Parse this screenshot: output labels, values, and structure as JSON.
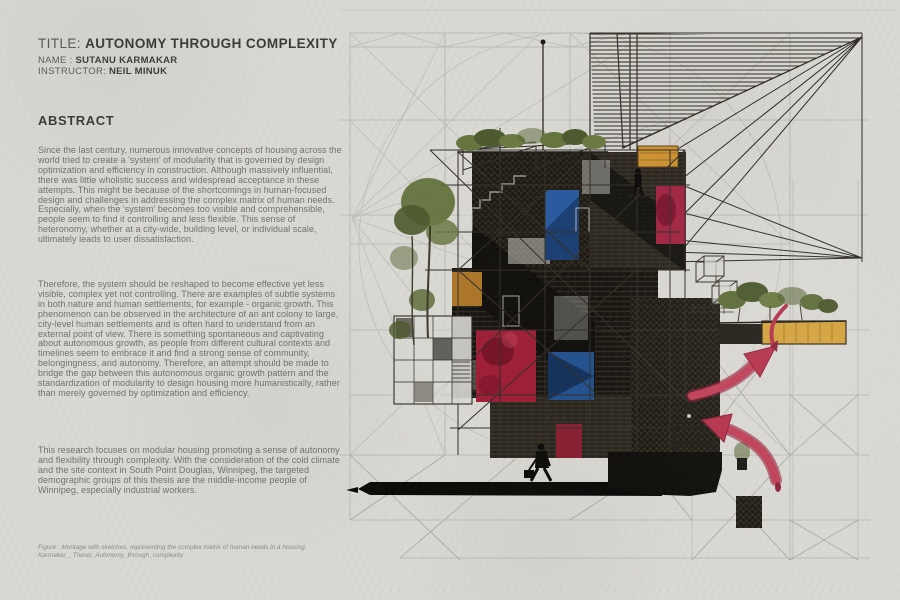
{
  "page": {
    "background_color": "#d9d8d3"
  },
  "header": {
    "title_prefix": "TITLE:",
    "title": "AUTONOMY THROUGH COMPLEXITY",
    "name_label": "NAME :",
    "name": "SUTANU KARMAKAR",
    "instructor_label": "INSTRUCTOR:",
    "instructor": "NEIL MINUK"
  },
  "abstract": {
    "heading": "ABSTRACT",
    "paragraphs": [
      "Since the last century, numerous innovative concepts of housing across the world tried to create a 'system' of modularity that is governed by design optimization and efficiency in construction. Although massively influential, there was little wholistic success and widespread acceptance in these attempts. This might be because of the shortcomings in human-focused design and challenges in addressing the complex matrix of human needs. Especially, when the 'system' becomes too visible and comprehensible, people seem to find it controlling and less flexible. This sense of heteronomy, whether at a city-wide, building level, or individual scale, ultimately leads to user dissatisfaction.",
      "Therefore, the system should be reshaped to become effective yet less visible, complex yet not controlling. There are examples of subtle systems in both nature and human settlements, for example - organic growth. This phenomenon can be observed in the architecture of an ant colony to large, city-level human settlements and is often hard to understand from an external point of view. There is something spontaneous and captivating about autonomous growth, as people from different cultural contexts and timelines seem to embrace it and find a strong sense of community, belongingness, and autonomy. Therefore, an attempt should be made to bridge the gap between this autonomous organic growth pattern and the standardization of modularity to design housing more humanistically, rather than merely governed by optimization and efficiency.",
      "This research focuses on modular housing promoting a sense of autonomy and flexibility through complexity. With the consideration of the cold climate and the site context in South Point Douglas, Winnipeg, the targeted demographic groups of this thesis are the middle-income people of Winnipeg, especially industrial workers."
    ]
  },
  "caption": {
    "line1": "Figure : Montage with sketches, representing the complex matrix of human needs in a housing.",
    "line2": "Karmakar__Thesis_Autonomy_through_complexity"
  },
  "figure": {
    "name": "thesis-montage-illustration",
    "colors": {
      "paper": "#d9d8d3",
      "pencil": "#b1b0aa",
      "ink": "#2e2b26",
      "crimson_arrow": "#b5334c",
      "panel_red": "#9e2038",
      "panel_blue": "#2b5a9e",
      "accent_amber": "#cf9433",
      "foliage_olive": "#68773f"
    }
  }
}
